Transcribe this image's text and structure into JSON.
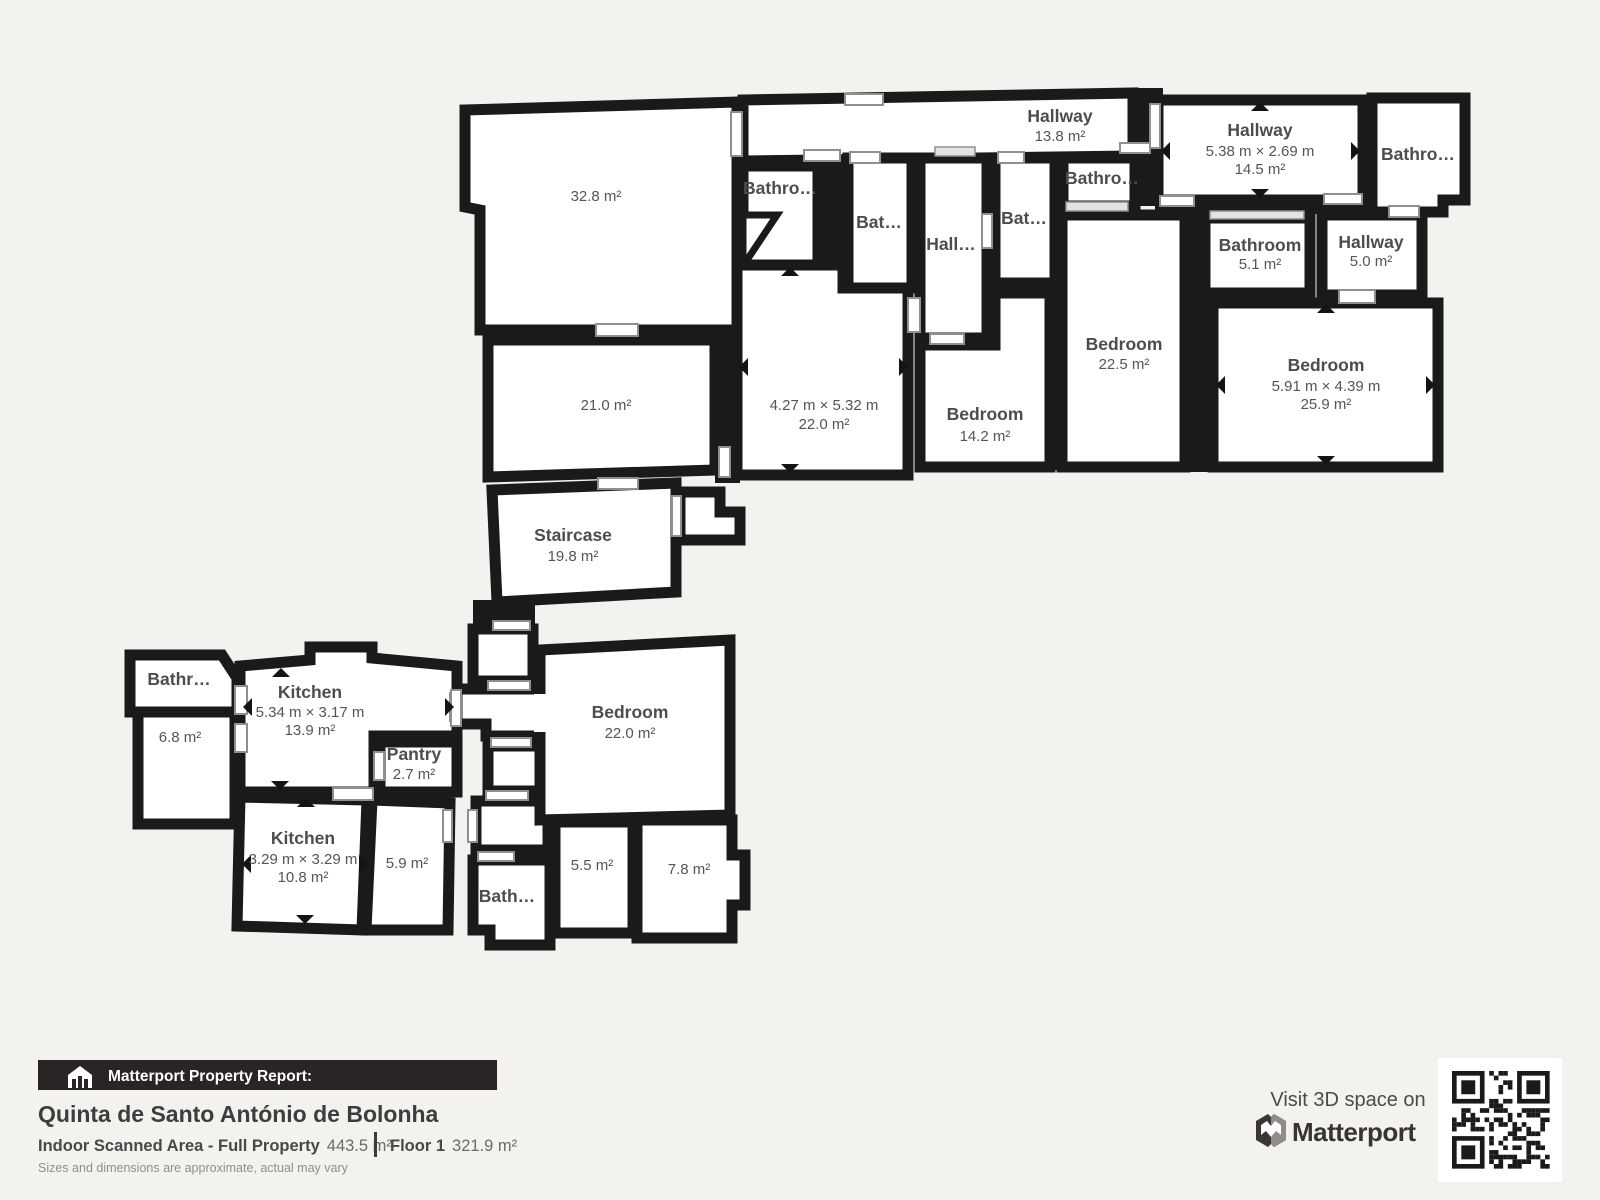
{
  "rooms": {
    "hallway_top": {
      "name": "Hallway",
      "area": "13.8 m²"
    },
    "bathroom_a": {
      "name": "Bathro…"
    },
    "bathroom_b": {
      "name": "Bat…"
    },
    "hallway_mid": {
      "name": "Hall…"
    },
    "bathroom_c": {
      "name": "Bat…"
    },
    "bathroom_d": {
      "name": "Bathro…"
    },
    "hallway_right": {
      "name": "Hallway",
      "dims": "5.38 m × 2.69 m",
      "area": "14.5 m²"
    },
    "bathroom_top_right": {
      "name": "Bathro…"
    },
    "room_32_8": {
      "area": "32.8 m²"
    },
    "room_21_0": {
      "area": "21.0 m²"
    },
    "room_22_0_upper": {
      "dims": "4.27 m × 5.32 m",
      "area": "22.0 m²"
    },
    "bedroom_14_2": {
      "name": "Bedroom",
      "area": "14.2 m²"
    },
    "bedroom_22_5": {
      "name": "Bedroom",
      "area": "22.5 m²"
    },
    "bathroom_5_1": {
      "name": "Bathroom",
      "area": "5.1 m²"
    },
    "hallway_5_0": {
      "name": "Hallway",
      "area": "5.0 m²"
    },
    "bedroom_25_9": {
      "name": "Bedroom",
      "dims": "5.91 m × 4.39 m",
      "area": "25.9 m²"
    },
    "staircase": {
      "name": "Staircase",
      "area": "19.8 m²"
    },
    "bedroom_22_0": {
      "name": "Bedroom",
      "area": "22.0 m²"
    },
    "bathroom_left": {
      "name": "Bathr…"
    },
    "room_6_8": {
      "area": "6.8 m²"
    },
    "kitchen_upper": {
      "name": "Kitchen",
      "dims": "5.34 m × 3.17 m",
      "area": "13.9 m²"
    },
    "pantry": {
      "name": "Pantry",
      "area": "2.7 m²"
    },
    "kitchen_lower": {
      "name": "Kitchen",
      "dims": "3.29 m × 3.29 m",
      "area": "10.8 m²"
    },
    "room_5_9": {
      "area": "5.9 m²"
    },
    "bathroom_small": {
      "name": "Bath…"
    },
    "room_5_5": {
      "area": "5.5 m²"
    },
    "room_7_8": {
      "area": "7.8 m²"
    }
  },
  "footer": {
    "report_label": "Matterport Property Report:",
    "property_name": "Quinta de Santo António de Bolonha",
    "scanned_area_label": "Indoor Scanned Area - Full Property",
    "scanned_area_value": "443.5 m²",
    "floor_label": "Floor 1",
    "floor_value": "321.9 m²",
    "disclaimer": "Sizes and dimensions are approximate, actual may vary",
    "visit_label": "Visit 3D space on",
    "brand": "Matterport"
  },
  "colors": {
    "background": "#f4f2ef",
    "wall": "#1a1a1a",
    "room_fill": "#ffffff",
    "label_text": "#4d4d4d",
    "report_bar": "#2a2524"
  }
}
